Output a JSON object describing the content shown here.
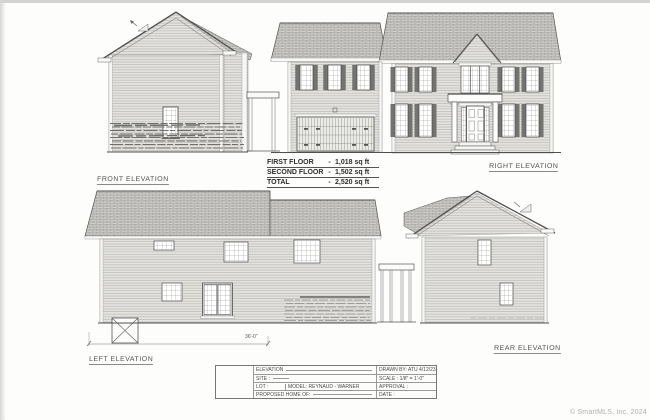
{
  "colors": {
    "paper": "#fdfdfc",
    "ink": "#4f4f4c",
    "watermark": "#aeaeae"
  },
  "labels": {
    "front": "FRONT ELEVATION",
    "right": "RIGHT ELEVATION",
    "left": "LEFT ELEVATION",
    "rear": "REAR ELEVATION"
  },
  "area_summary": {
    "rows": [
      {
        "name": "FIRST FLOOR",
        "sep": "-",
        "value": "1,018 sq ft"
      },
      {
        "name": "SECOND FLOOR",
        "sep": "-",
        "value": "1,502 sq ft"
      },
      {
        "name": "TOTAL",
        "sep": "-",
        "value": "2,520 sq ft"
      }
    ]
  },
  "dimension": "36'-0\"",
  "title_block": {
    "row1_left": "ELEVATION",
    "row1_right": "DRAWN BY: ATU 4/12/23",
    "row2_left": "SITE :",
    "row2_right": "SCALE : 1/8\" = 1'-0\"",
    "row3_left": "LOT :",
    "row3_model": "MODEL: REYNAUD - WARNER",
    "row3_right": "APPROVAL :",
    "row4_left": "PROPOSED HOME OF:",
    "row4_right": "DATE :"
  },
  "watermark": "© SmartMLS, Inc. 2024"
}
